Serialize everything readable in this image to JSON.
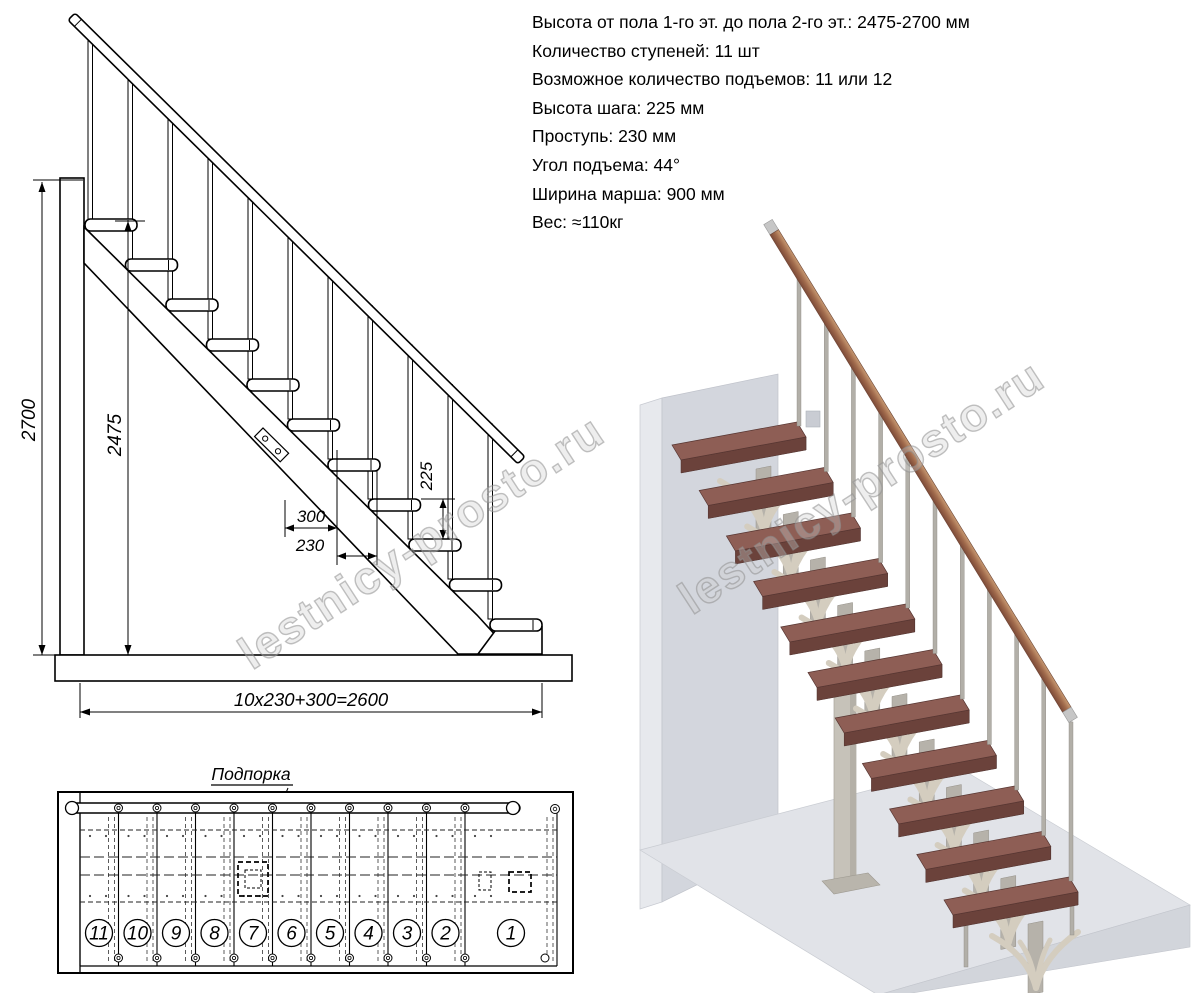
{
  "specs": {
    "lines": [
      "Высота от пола 1-го эт. до пола 2-го эт.: 2475-2700 мм",
      "Количество ступеней: 11 шт",
      "Возможное количество подъемов: 11 или 12",
      "Высота шага: 225 мм",
      "Проступь: 230 мм",
      "Угол подъема: 44°",
      "Ширина марша: 900 мм",
      "Вес: ≈110кг"
    ]
  },
  "elevation": {
    "dim_total_height": "2700",
    "dim_height_to_top_step": "2475",
    "dim_riser": "225",
    "dim_bottom_run": "300",
    "dim_tread_run": "230",
    "dim_total_run": "10x230+300=2600"
  },
  "plan": {
    "support_label": "Подпорка",
    "step_numbers": [
      "11",
      "10",
      "9",
      "8",
      "7",
      "6",
      "5",
      "4",
      "3",
      "2",
      "1"
    ]
  },
  "watermark": {
    "text": "lestnicy-prosto.ru"
  },
  "colors": {
    "tread_top": "#8e5e55",
    "tread_front": "#6b423b",
    "tread_side": "#7a4d44",
    "bracket": "#d4cdbf",
    "bracket_stem": "#b6b2aa",
    "metal": "#b2afa8",
    "rail_wood_light": "#c89a72",
    "rail_wood_dark": "#7c4a38",
    "wall": "#d3d6dd",
    "floor": "#e1e3e8",
    "drawing_line": "#000000"
  }
}
